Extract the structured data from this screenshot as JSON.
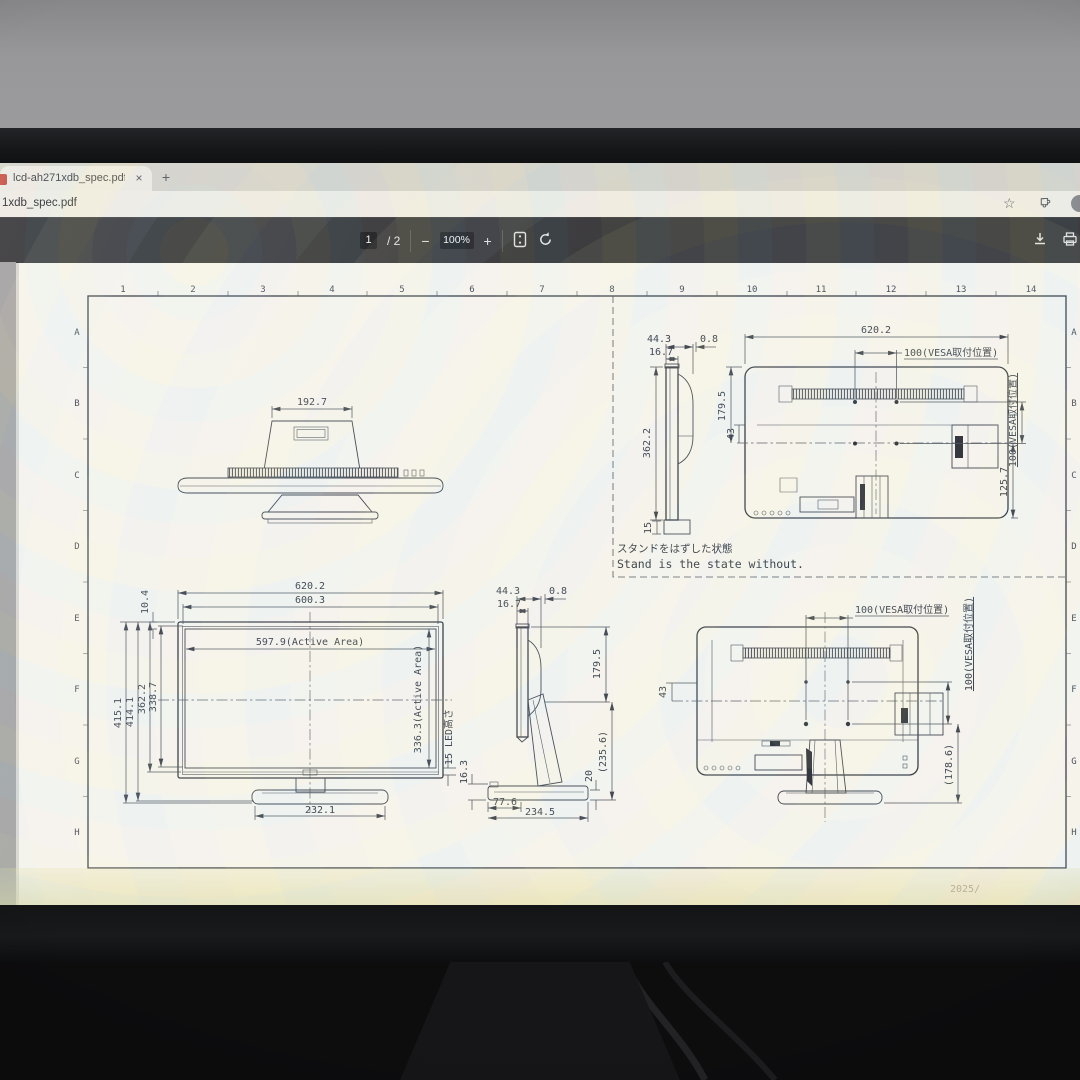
{
  "scene": {
    "footer_faint": "2025/"
  },
  "browser": {
    "tab": {
      "title": "lcd-ah271xdb_spec.pdf",
      "close_label": "×",
      "new_tab_label": "+"
    },
    "address": {
      "url_tail": "1xdb_spec.pdf"
    },
    "toolbar": {
      "page_current": "1",
      "page_of": "/ 2",
      "zoom_out": "−",
      "zoom_level": "100%",
      "zoom_in": "+"
    }
  },
  "sheet": {
    "grid_cols": [
      "1",
      "2",
      "3",
      "4",
      "5",
      "6",
      "7",
      "8",
      "9",
      "10",
      "11",
      "12",
      "13",
      "14"
    ],
    "grid_rows": [
      "A",
      "B",
      "C",
      "D",
      "E",
      "F",
      "G",
      "H"
    ],
    "note_jp": "スタンドをはずした状態",
    "note_en": "Stand is the state without."
  },
  "dims": {
    "top_view": {
      "stand_width": "192.7"
    },
    "side_ns": {
      "depth": "44.3",
      "panel": "16.7",
      "lip": "0.8",
      "height": "362.2",
      "foot": "15"
    },
    "rear_ns": {
      "width": "620.2",
      "vesa_h": "100(VESA取付位置)",
      "vesa_v": "100(VESA取付位置)",
      "to_center": "179.5",
      "offset": "43",
      "lower": "125.7"
    },
    "front": {
      "w_outer": "620.2",
      "w_inner": "600.3",
      "w_active": "597.9(Active Area)",
      "bezel": "10.4",
      "h_total": "415.1",
      "h_total2": "414.1",
      "h_panel": "362.2",
      "h_inner": "338.7",
      "h_active": "336.3(Active Area)",
      "led": "15 LED高さ",
      "base_width": "232.1"
    },
    "side_ws": {
      "depth": "44.3",
      "panel": "16.7",
      "lip": "0.8",
      "upper": "179.5",
      "total": "(235.6)",
      "base": "20",
      "lip_h": "16.3",
      "base_front": "77.6",
      "base_depth": "234.5"
    },
    "rear_ws": {
      "vesa_h": "100(VESA取付位置)",
      "vesa_v": "100(VESA取付位置)",
      "offset": "43",
      "lower": "(178.6)"
    }
  }
}
